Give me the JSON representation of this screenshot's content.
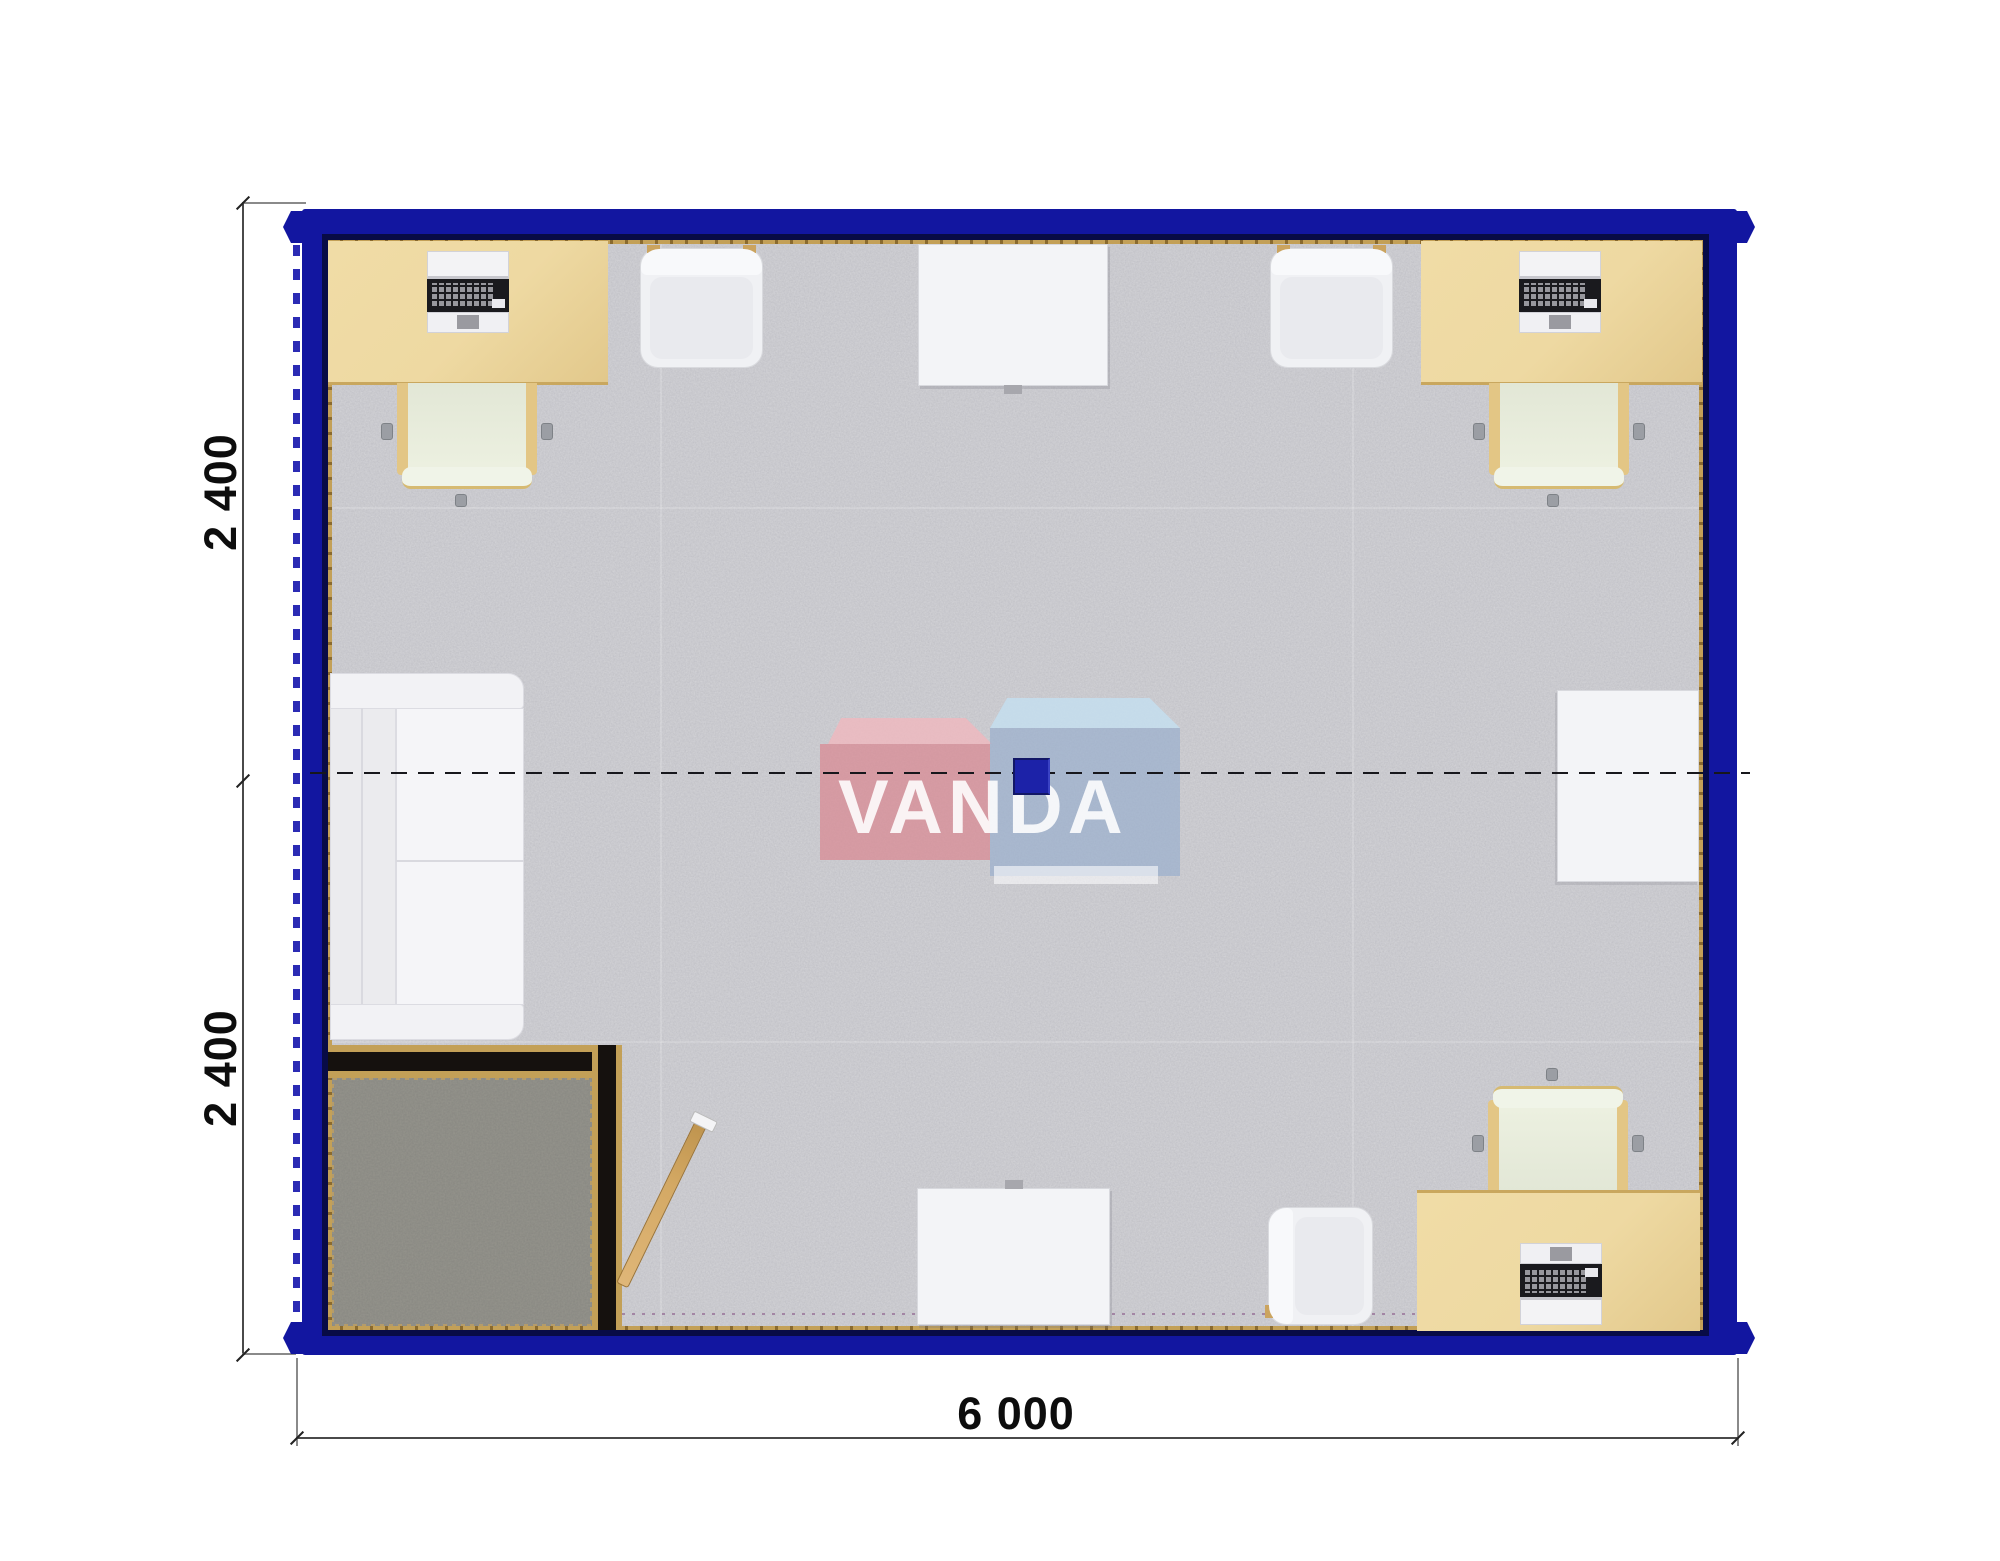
{
  "drawing": {
    "type": "container-office-floor-plan",
    "dimensions": {
      "bottom_width": {
        "label": "6 000"
      },
      "left_height_top": {
        "label": "2 400"
      },
      "left_height_bottom": {
        "label": "2 400"
      }
    },
    "watermark": {
      "brand": "VANDA"
    },
    "colors": {
      "wall_color": "#1216a0",
      "trim_color": "#c3a057",
      "carpet_color": "#c9c9ce",
      "vestibule_carpet_color": "#96958d",
      "desk_color": "#eed9a2",
      "partition_color": "#15110e",
      "door_color": "#d4a964",
      "column_color": "#1c22a8",
      "dimension_text_color": "#0d0d0d"
    },
    "furniture_inventory": {
      "desks_with_computers": 3,
      "task_chairs": 3,
      "visitor_chairs": 3,
      "white_tables": 3,
      "sofas": 1,
      "entry_vestibules": 1,
      "doors": 1
    }
  }
}
